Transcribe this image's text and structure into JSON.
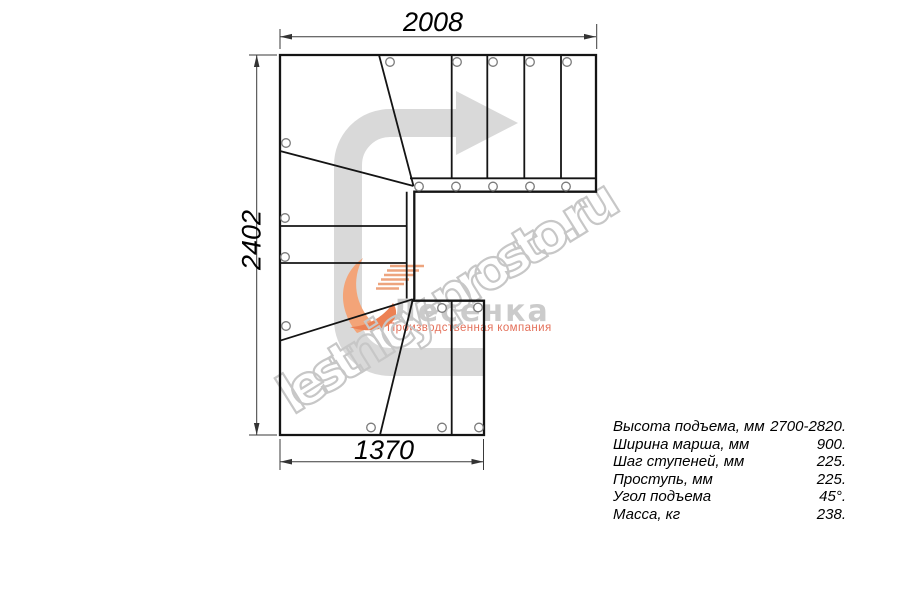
{
  "drawing": {
    "dim_top": "2008",
    "dim_left": "2402",
    "dim_bottom": "1370"
  },
  "watermark": {
    "text": "lestnicy-prosto.ru"
  },
  "logo": {
    "name": "Лесенка",
    "subtitle": "Производственная компания"
  },
  "specs": {
    "rows": [
      {
        "label": "Высота подъема, мм",
        "value": "2700-2820."
      },
      {
        "label": "Ширина марша, мм",
        "value": "900."
      },
      {
        "label": "Шаг ступеней, мм",
        "value": "225."
      },
      {
        "label": "Проступь, мм",
        "value": "225."
      },
      {
        "label": "Угол подъема",
        "value": "45°."
      },
      {
        "label": "Масса, кг",
        "value": "238."
      }
    ]
  },
  "colors": {
    "line": "#141414",
    "dimension": "#3a3a3a",
    "direction_arrow": "#d9d9d9",
    "watermark": "#c7c7c7",
    "logo_gray": "#cbcbcb",
    "logo_orange": "#ef8457",
    "logo_red": "#e4705a"
  }
}
